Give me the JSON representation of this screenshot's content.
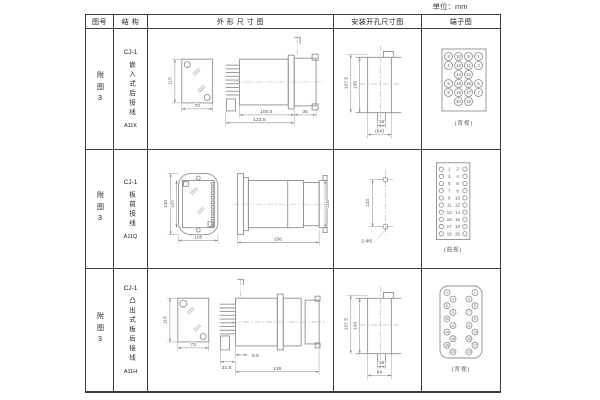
{
  "unit_label": "单位：mm",
  "headers": {
    "figure_no": "图号",
    "structure": "结 构",
    "outline": "外 形 尺 寸 图",
    "mounting": "安装开孔尺寸图",
    "terminal": "端子图"
  },
  "rows": [
    {
      "figure_no": "附图3",
      "structure": {
        "model": "CJ-1",
        "desc": "嵌入式后接线",
        "code": "A11K"
      },
      "outline": {
        "front_height": "115",
        "front_width": "72",
        "d1": "100.5",
        "d2": "122.5",
        "d3": "35"
      },
      "mounting": {
        "v_outer": "107.5",
        "v_inner": "105",
        "slot": "16",
        "width": "(64)"
      },
      "terminal": {
        "caption": "(背视)",
        "view": "back",
        "grid": [
          [
            2,
            10,
            9,
            1
          ],
          [
            4,
            12,
            11,
            3
          ],
          [
            null,
            14,
            13,
            null
          ],
          [
            6,
            16,
            15,
            5
          ],
          [
            8,
            18,
            17,
            7
          ],
          [
            null,
            20,
            19,
            null
          ]
        ]
      }
    },
    {
      "figure_no": "附图3",
      "structure": {
        "model": "CJ-1",
        "desc": "板前接线",
        "code": "A11Q"
      },
      "outline": {
        "h_outer": "140",
        "h_inner": "125",
        "front_width": "105",
        "side_width": "156",
        "side_height": "115"
      },
      "mounting": {
        "spacing": "133",
        "hole_label": "2-Φ5"
      },
      "terminal": {
        "caption": "(前视)",
        "view": "front",
        "left": [
          1,
          3,
          5,
          7,
          9,
          11,
          13,
          15,
          17,
          19
        ],
        "right": [
          2,
          4,
          6,
          8,
          10,
          12,
          14,
          16,
          18,
          20
        ]
      }
    },
    {
      "figure_no": "附图3",
      "structure": {
        "model": "CJ-1",
        "desc": "凸出式板后接线",
        "code": "A11H"
      },
      "outline": {
        "front_height": "115",
        "front_width": "72",
        "d1": "31.5",
        "d2": "9.5",
        "d3": "126"
      },
      "mounting": {
        "v_outer": "107.5",
        "v_inner": "104",
        "slot": "16",
        "width": "64"
      },
      "terminal": {
        "caption": "(背视)",
        "view": "back",
        "pairs": [
          [
            2,
            1
          ],
          [
            4,
            3
          ],
          [
            6,
            5
          ],
          [
            8,
            7
          ],
          [
            10,
            9
          ],
          [
            12,
            11
          ],
          [
            14,
            13
          ],
          [
            16,
            15
          ],
          [
            18,
            17
          ],
          [
            20,
            19
          ]
        ]
      }
    }
  ]
}
